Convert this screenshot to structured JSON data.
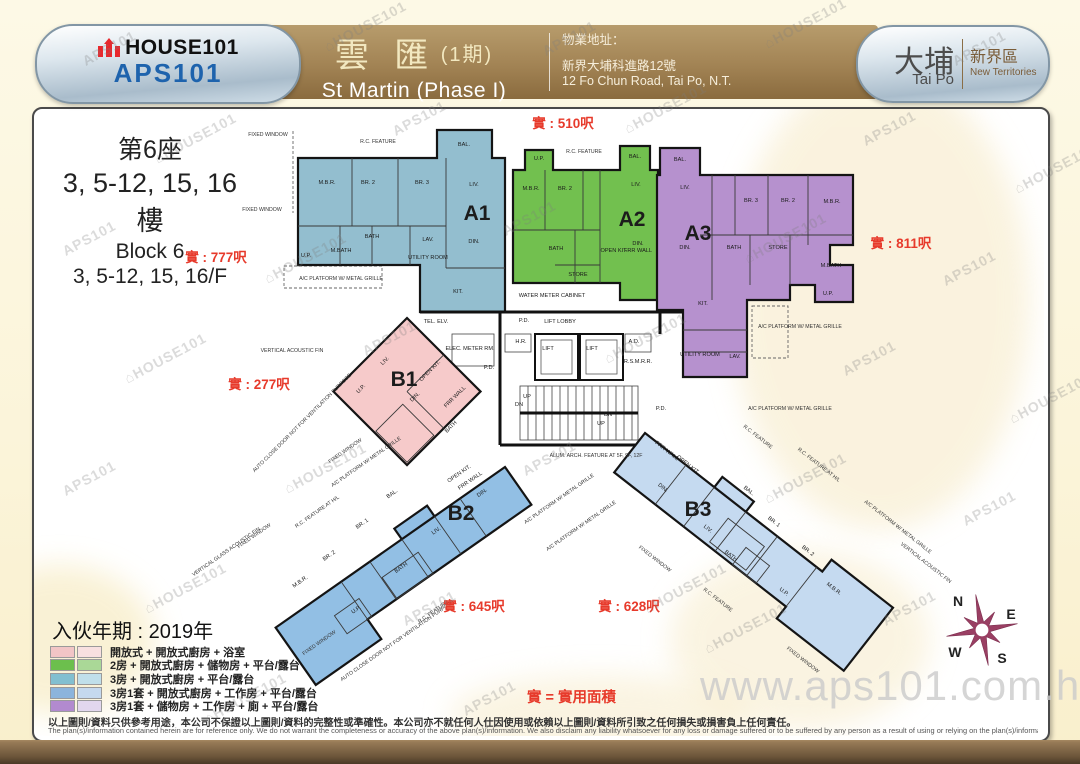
{
  "header": {
    "brand_top": "HOUSE101",
    "brand_bottom": "APS101",
    "title_cn": "雲 匯",
    "title_phase": "(1期)",
    "title_en": "St Martin (Phase I)",
    "address_label": "物業地址：",
    "address_cn": "新界大埔科進路12號",
    "address_en": "12 Fo Chun Road, Tai Po, N.T.",
    "district_cn": "大埔",
    "district_en": "Tai Po",
    "region_cn": "新界區",
    "region_en": "New Territories"
  },
  "block_info": {
    "line1": "第6座",
    "line2": "3, 5-12, 15, 16樓",
    "line3": "Block 6",
    "line4": "3, 5-12, 15, 16/F"
  },
  "move_in": "入伙年期 : 2019年",
  "area_note": "實 = 實用面積",
  "legend": [
    {
      "colors": [
        "#f2c5c6",
        "#f8e0e0"
      ],
      "label": "開放式 + 開放式廚房 + 浴室"
    },
    {
      "colors": [
        "#6cbf4d",
        "#aad897"
      ],
      "label": "2房 + 開放式廚房 + 儲物房 + 平台/露台"
    },
    {
      "colors": [
        "#82bfd0",
        "#c0dfea"
      ],
      "label": "3房 + 開放式廚房 + 平台/露台"
    },
    {
      "colors": [
        "#8cb4dc",
        "#c5d9ef"
      ],
      "label": "3房1套 + 開放式廚房 + 工作房 + 平台/露台"
    },
    {
      "colors": [
        "#b28acf",
        "#e2d7ee"
      ],
      "label": "3房1套 + 儲物房 + 工作房 + 廁 + 平台/露台"
    }
  ],
  "disclaimer_cn": "以上圖則/資料只供參考用途，本公司不保證以上圖則/資料的完整性或準確性。本公司亦不就任何人仕因使用或依賴以上圖則/資料所引致之任何損失或損害負上任何責任。",
  "disclaimer_en": "The plan(s)/information contained herein are for reference only. We do not warrant the completeness or accuracy of the above plan(s)/information. We also disclaim any liability whatsoever for any loss or damage suffered or to be suffered by any person as a result of using or relying on the plan(s)/information.",
  "watermark": {
    "aps": "APS101",
    "house": "HOUSE101",
    "house_icon": "⌂",
    "url": "www.aps101.com.hk"
  },
  "compass": {
    "n": "N",
    "e": "E",
    "s": "S",
    "w": "W"
  },
  "plan": {
    "units": [
      {
        "id": "A1",
        "label": "A1",
        "color": "#93becf",
        "label_pos": [
          477,
          220
        ],
        "rooms": [
          [
            "BAL.",
            464,
            146
          ],
          [
            "M.B.R.",
            327,
            184
          ],
          [
            "BR. 2",
            368,
            184
          ],
          [
            "BR. 3",
            422,
            184
          ],
          [
            "LIV.",
            474,
            186
          ],
          [
            "DIN.",
            474,
            243
          ],
          [
            "BATH",
            372,
            238
          ],
          [
            "M.BATH",
            341,
            252
          ],
          [
            "LAV.",
            428,
            241
          ],
          [
            "UTILITY ROOM",
            428,
            259
          ],
          [
            "KIT.",
            458,
            293
          ],
          [
            "U.P.",
            306,
            257
          ]
        ]
      },
      {
        "id": "A2",
        "label": "A2",
        "color": "#72c04f",
        "label_pos": [
          632,
          226
        ],
        "rooms": [
          [
            "U.P.",
            539,
            160
          ],
          [
            "BAL.",
            635,
            158
          ],
          [
            "M.B.R.",
            531,
            190
          ],
          [
            "BR. 2",
            565,
            190
          ],
          [
            "LIV.",
            636,
            186
          ],
          [
            "BATH",
            556,
            250
          ],
          [
            "OPEN KIT.",
            614,
            252
          ],
          [
            "DIN.",
            638,
            245
          ],
          [
            "FRR WALL",
            638,
            252
          ],
          [
            "STORE",
            578,
            276
          ]
        ]
      },
      {
        "id": "A3",
        "label": "A3",
        "color": "#b691ce",
        "label_pos": [
          698,
          240
        ],
        "rooms": [
          [
            "BAL.",
            680,
            161
          ],
          [
            "LIV.",
            685,
            189
          ],
          [
            "BR. 3",
            751,
            202
          ],
          [
            "BR. 2",
            788,
            202
          ],
          [
            "M.B.R.",
            832,
            203
          ],
          [
            "DIN.",
            685,
            249
          ],
          [
            "BATH",
            734,
            249
          ],
          [
            "STORE",
            778,
            249
          ],
          [
            "M.BATH",
            831,
            267
          ],
          [
            "U.P.",
            828,
            295
          ],
          [
            "KIT.",
            703,
            305
          ],
          [
            "UTILITY ROOM",
            700,
            356
          ],
          [
            "LAV.",
            735,
            358
          ]
        ]
      },
      {
        "id": "B1",
        "label": "B1",
        "color": "#f6caca",
        "label_pos": [
          404,
          386
        ],
        "rooms": [
          [
            "LIV.",
            386,
            362,
            -45
          ],
          [
            "OPEN KIT.",
            431,
            372,
            -45
          ],
          [
            "DIN.",
            416,
            398,
            -45
          ],
          [
            "FRR WALL",
            456,
            398,
            -45
          ],
          [
            "BATH",
            452,
            428,
            -45
          ],
          [
            "U.P.",
            362,
            390,
            -45
          ]
        ]
      },
      {
        "id": "B2",
        "label": "B2",
        "color": "#92bfe4",
        "label_pos": [
          461,
          520
        ],
        "rooms": [
          [
            "OPEN KIT.",
            460,
            475,
            -35
          ],
          [
            "FRR WALL",
            471,
            482,
            -35
          ],
          [
            "DIN.",
            483,
            494,
            -35
          ],
          [
            "BAL.",
            393,
            495,
            -35
          ],
          [
            "LIV.",
            437,
            532,
            -35
          ],
          [
            "BR. 1",
            363,
            525,
            -35
          ],
          [
            "BR. 2",
            330,
            557,
            -35
          ],
          [
            "M.B.R.",
            301,
            583,
            -35
          ],
          [
            "BATH",
            402,
            569,
            -35
          ],
          [
            "U.P.",
            357,
            611,
            -35
          ]
        ]
      },
      {
        "id": "B3",
        "label": "B3",
        "color": "#c5daf0",
        "label_pos": [
          698,
          516
        ],
        "rooms": [
          [
            "FRR WALL",
            666,
            452,
            38
          ],
          [
            "OPEN KIT.",
            687,
            466,
            38
          ],
          [
            "DIN.",
            662,
            489,
            38
          ],
          [
            "LIV.",
            707,
            530,
            38
          ],
          [
            "BAL.",
            748,
            492,
            38
          ],
          [
            "BR. 1",
            773,
            523,
            38
          ],
          [
            "BR. 2",
            807,
            552,
            38
          ],
          [
            "M.B.R.",
            833,
            590,
            38
          ],
          [
            "BATH",
            730,
            557,
            38
          ],
          [
            "U.P.",
            783,
            593,
            38
          ]
        ]
      }
    ],
    "core_labels": [
      [
        "WATER METER CABINET",
        552,
        297
      ],
      [
        "LIFT LOBBY",
        560,
        323
      ],
      [
        "P.D.",
        524,
        322
      ],
      [
        "TEL. ELV.",
        436,
        323
      ],
      [
        "ELEC. METER RM.",
        470,
        350
      ],
      [
        "H.R.",
        521,
        343
      ],
      [
        "LIFT",
        548,
        350
      ],
      [
        "LIFT",
        592,
        350
      ],
      [
        "A.D.",
        634,
        343
      ],
      [
        "R.S.M.R.R.",
        638,
        363
      ],
      [
        "P.D.",
        489,
        369
      ],
      [
        "P.D.",
        661,
        410
      ],
      [
        "UP",
        527,
        398
      ],
      [
        "DN",
        519,
        406
      ],
      [
        "DN",
        608,
        416
      ],
      [
        "UP",
        601,
        425
      ]
    ],
    "annotations": [
      [
        "FIXED WINDOW",
        268,
        136
      ],
      [
        "R.C. FEATURE",
        378,
        143
      ],
      [
        "R.C. FEATURE",
        584,
        153
      ],
      [
        "FIXED WINDOW",
        262,
        211
      ],
      [
        "A/C PLATFORM W/ METAL GRILLE",
        341,
        280
      ],
      [
        "VERTICAL ACOUSTIC FIN",
        292,
        352
      ],
      [
        "A/C PLATFORM W/ METAL GRILLE",
        800,
        328
      ],
      [
        "A/C PLATFORM W/ METAL GRILLE",
        790,
        410
      ],
      [
        "AUTO CLOSE DOOR NOT FOR VENTILATION PURPOSE",
        303,
        424,
        -45
      ],
      [
        "FIXED WINDOW",
        346,
        452,
        -35
      ],
      [
        "A/C PLATFORM W/ METAL GRILLE",
        367,
        463,
        -35
      ],
      [
        "R.C. FEATURE AT H/L",
        318,
        513,
        -35
      ],
      [
        "FIXED WINDOW",
        255,
        537,
        -35
      ],
      [
        "VERTICAL GLASS ACOUSTIC FIN",
        227,
        553,
        -35
      ],
      [
        "FIXED WINDOW",
        320,
        644,
        -35
      ],
      [
        "AUTO CLOSE DOOR NOT FOR VENTILATION PURPOSE",
        398,
        642,
        -35
      ],
      [
        "R.C. FEATURE",
        434,
        613,
        -35
      ],
      [
        "A/C PLATFORM W/ METAL GRILLE",
        560,
        500,
        -35
      ],
      [
        "A/C PLATFORM W/ METAL GRILLE",
        582,
        527,
        -35
      ],
      [
        "ALUM. ARCH. FEATURE AT 5F, 9F, 12F",
        596,
        457
      ],
      [
        "R.C. FEATURE",
        757,
        438,
        38
      ],
      [
        "R.C. FEATURE AT H/L",
        818,
        466,
        38
      ],
      [
        "A/C PLATFORM W/ METAL GRILLE",
        897,
        528,
        38
      ],
      [
        "VERTICAL ACOUSTIC FIN",
        925,
        564,
        38
      ],
      [
        "FIXED WINDOW",
        654,
        560,
        38
      ],
      [
        "R.C. FEATURE",
        717,
        601,
        38
      ],
      [
        "FIXED WINDOW",
        802,
        661,
        38
      ]
    ],
    "area_labels": [
      [
        "實 : 510呎",
        563,
        128
      ],
      [
        "實 : 777呎",
        216,
        262
      ],
      [
        "實 : 811呎",
        901,
        248
      ],
      [
        "實 : 277呎",
        259,
        389
      ],
      [
        "實 : 645呎",
        474,
        611
      ],
      [
        "實 : 628呎",
        629,
        611
      ]
    ]
  }
}
